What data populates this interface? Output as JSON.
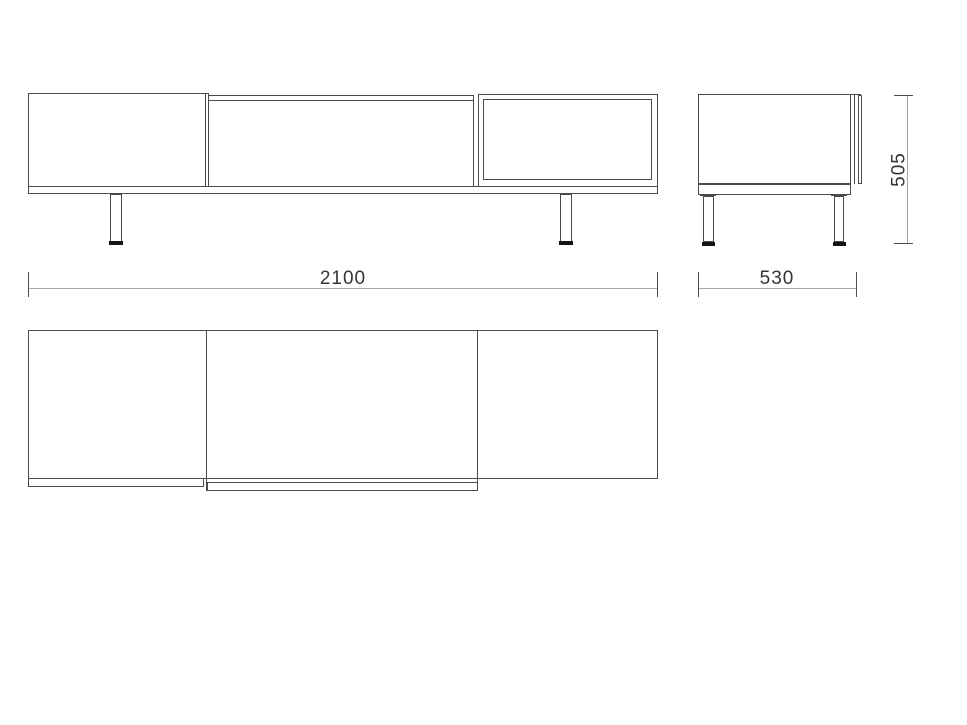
{
  "dimensions": {
    "width_mm": "2100",
    "depth_mm": "530",
    "height_mm": "505"
  },
  "colors": {
    "line": "#4b4b4b",
    "dim_line": "#a6a6a6",
    "tick": "#4f4f4f",
    "dim_text": "#353535",
    "foot": "#141414",
    "background": "#ffffff"
  }
}
